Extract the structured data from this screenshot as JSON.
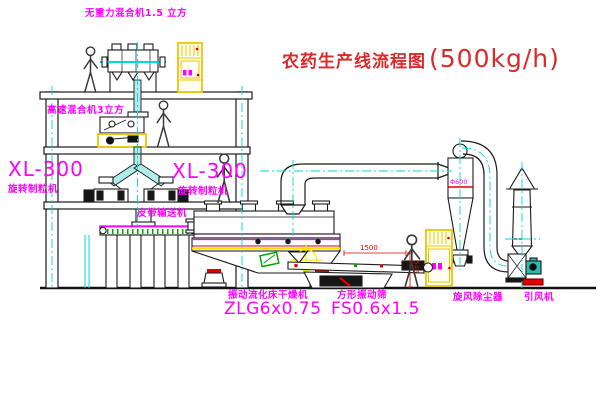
{
  "header": {
    "title_zh": "农药生产线流程图",
    "title_capacity": "(500kg/h)"
  },
  "labels": {
    "gravity_mixer": "无重力混合机1.5 立方",
    "high_speed_mixer": "高速混合机3立方",
    "granulator_left_model": "XL-300",
    "granulator_left_name": "旋转制粒机",
    "granulator_mid_model": "XL-300",
    "granulator_mid_name": "旋转制粒机",
    "belt_conveyor": "皮带输送机",
    "dryer_name": "振动流化床干燥机",
    "dryer_model": "ZLG6x0.75",
    "sieve_name": "方形振动筛",
    "sieve_model": "FS0.6x1.5",
    "cyclone_name": "旋风除尘器",
    "cyclone_size": "Φ600",
    "fan_name": "引风机"
  },
  "dimensions": {
    "sieve_length": "1500",
    "sieve_height": "545"
  },
  "colors": {
    "label_magenta": "#ff00ff",
    "title_red": "#d92b2b",
    "centerline_cyan": "#00d8d8",
    "cabinet_yellow": "#e8c800",
    "hatch_green": "#00a800",
    "dim_red": "#e00000"
  }
}
